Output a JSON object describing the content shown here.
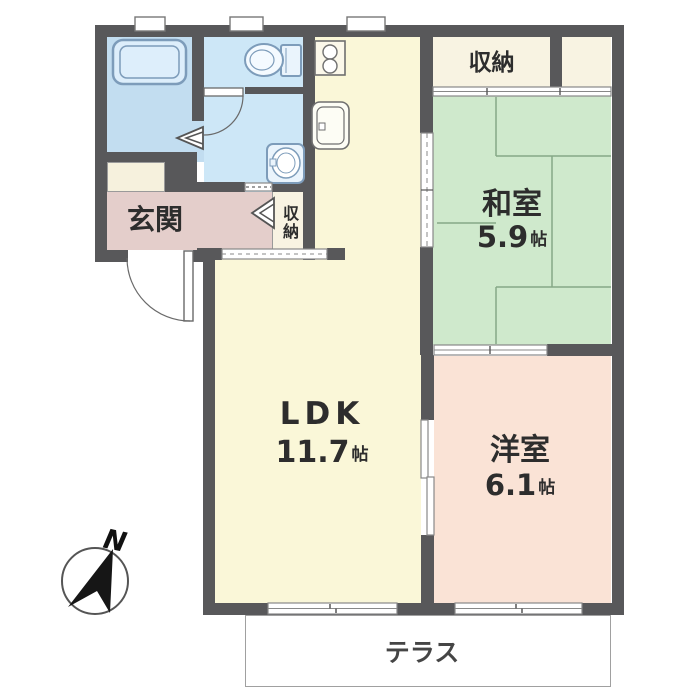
{
  "floorplan": {
    "rooms": {
      "ldk": {
        "name": "LDK",
        "size": "11.7",
        "unit": "帖"
      },
      "washitsu": {
        "name": "和室",
        "size": "5.9",
        "unit": "帖"
      },
      "yoshitsu": {
        "name": "洋室",
        "size": "6.1",
        "unit": "帖"
      },
      "genkan": {
        "name": "玄関"
      },
      "closet_top": {
        "name": "収納"
      },
      "closet_hall": {
        "name": "収納"
      },
      "terrace": {
        "name": "テラス"
      }
    },
    "compass": {
      "label": "N"
    },
    "colors": {
      "wall": "#58585a",
      "ldk": "#faf7d8",
      "tatami": "#cfe9cc",
      "western": "#fae3d6",
      "entry": "#e4cecb",
      "wet": "#cde7f7",
      "bath": "#c2ddf0",
      "closet": "#f8f3e2"
    }
  }
}
